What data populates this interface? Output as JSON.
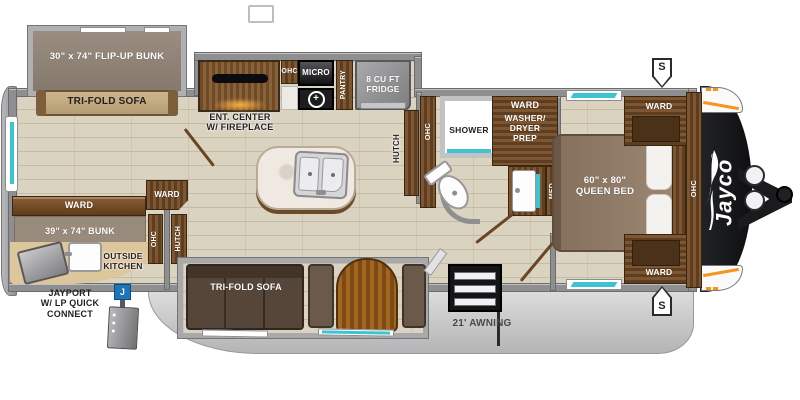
{
  "title": "Jayco travel trailer floor plan",
  "labels": {
    "flip_up_bunk": "30\" x 74\" FLIP-UP BUNK",
    "tri_fold_sofa": "TRI-FOLD SOFA",
    "ent_center": "ENT. CENTER\nW/ FIREPLACE",
    "ohc": "OHC",
    "micro": "MICRO",
    "pantry": "PANTRY",
    "fridge": "8 CU FT\nFRIDGE",
    "hutch": "HUTCH",
    "shower": "SHOWER",
    "ward": "WARD",
    "washer": "WASHER/\nDRYER\nPREP",
    "med": "MED",
    "queen_bed": "60\" x 80\"\nQUEEN BED",
    "bunk": "39\" x 74\" BUNK",
    "outside_kitchen": "OUTSIDE\nKITCHEN",
    "jayport": "JAYPORT\nW/ LP QUICK\nCONNECT",
    "awning": "21' AWNING",
    "speaker": "S",
    "jayport_connector": "J",
    "brand": "Jayco",
    "brand_mark": "®"
  },
  "icons": {
    "burner": "+"
  },
  "colors": {
    "teal_accent": "#3cc4d0",
    "jayport_blue": "#1b75bb",
    "marker_orange": "#f7941d",
    "wood_dark": "#5e3e20",
    "wall_gray": "#8f8f91",
    "floor_beige": "#dad3c0",
    "front_cap_black": "#17181a"
  }
}
